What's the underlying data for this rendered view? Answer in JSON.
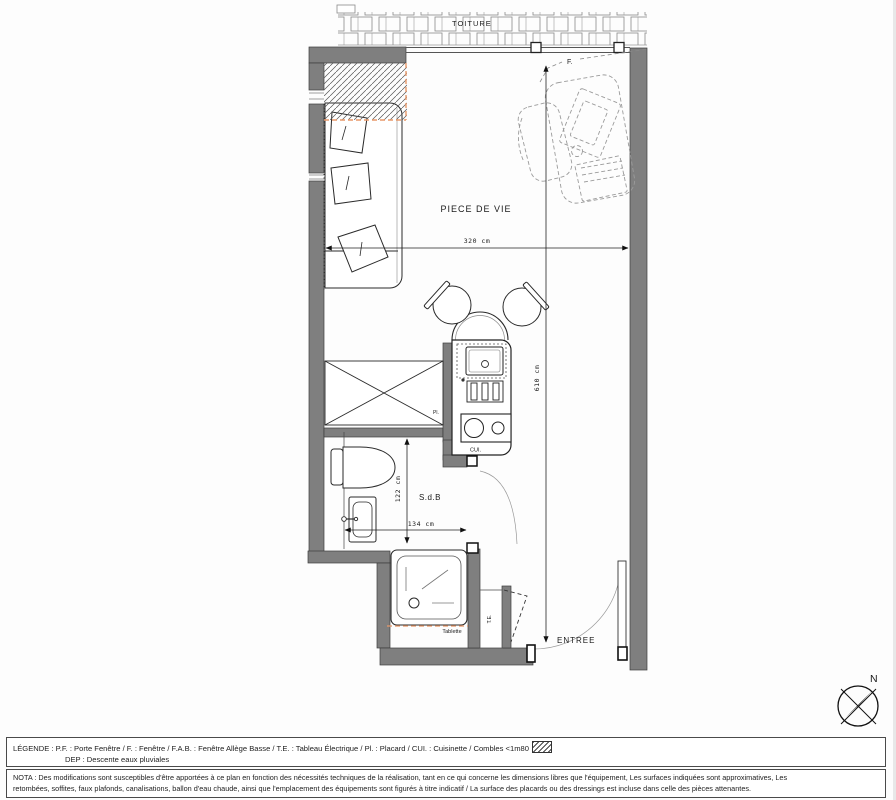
{
  "plan": {
    "labels": {
      "roof": "TOITURE",
      "window": "F.",
      "living_room": "PIECE DE VIE",
      "bathroom": "S.d.B",
      "entrance": "ENTREE",
      "kitchenette": "CUI.",
      "closet": "Pl.",
      "electrical_panel": "T.E.",
      "shelf": "Tablette",
      "north": "N"
    },
    "dimensions": {
      "living_width": "320 cm",
      "living_length": "610 cm",
      "bathroom_length": "122 cm",
      "bathroom_width": "134 cm"
    },
    "colors": {
      "wall": "#7f7f7f",
      "wall_edge": "#3c3c3c",
      "line": "#1a1a1a",
      "accent_dash": "#e8996a",
      "furniture_dash": "#9b9b9b"
    }
  },
  "legend": {
    "line1": "LÉGENDE : P.F. : Porte Fenêtre / F. : Fenêtre / F.A.B. : Fenêtre Allège Basse / T.E. : Tableau Électrique / Pl. : Placard / CUI. : Cuisinette / Combles <1m80",
    "line2": "DEP : Descente eaux pluviales"
  },
  "nota": {
    "line1": "NOTA : Des modifications sont susceptibles d'être apportées à ce plan en fonction des nécessités techniques de la réalisation, tant en ce qui concerne les dimensions libres que l'équipement, Les surfaces indiquées sont approximatives, Les",
    "line2": "retombées, soffites, faux plafonds, canalisations, ballon d'eau chaude, ainsi que l'emplacement des équipements sont figurés à titre indicatif / La surface des placards ou des dressings est incluse dans celle des pièces attenantes."
  }
}
